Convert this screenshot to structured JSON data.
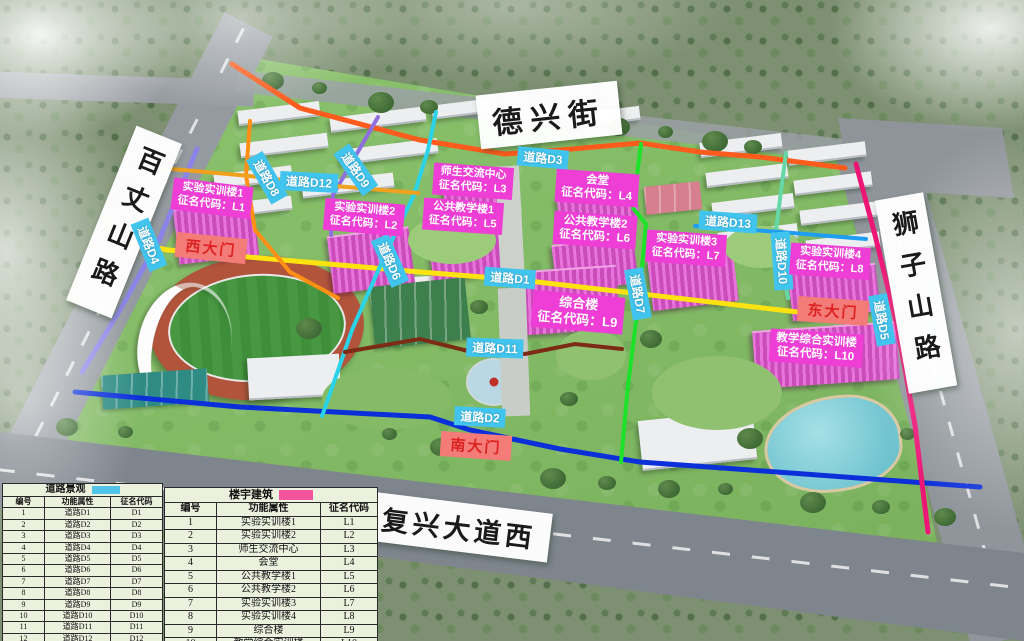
{
  "streets": {
    "top": "德兴街",
    "left": "百丈山路",
    "right": "狮子山路",
    "bottom": "复兴大道西"
  },
  "gates": [
    {
      "id": "west",
      "label": "西大门"
    },
    {
      "id": "east",
      "label": "东大门"
    },
    {
      "id": "south",
      "label": "南大门"
    }
  ],
  "roads": [
    {
      "id": "D1",
      "label": "道路D1",
      "line_color": "#ffe311"
    },
    {
      "id": "D2",
      "label": "道路D2",
      "line_color": "#0b2fd9"
    },
    {
      "id": "D3",
      "label": "道路D3",
      "line_color": "#fe5b1c"
    },
    {
      "id": "D4",
      "label": "道路D4",
      "line_color": "#8a84e8"
    },
    {
      "id": "D5",
      "label": "道路D5",
      "line_color": "#ed1677"
    },
    {
      "id": "D6",
      "label": "道路D6",
      "line_color": "#2bd3e9"
    },
    {
      "id": "D7",
      "label": "道路D7",
      "line_color": "#1ce32a"
    },
    {
      "id": "D8",
      "label": "道路D8",
      "line_color": "#ff9015"
    },
    {
      "id": "D9",
      "label": "道路D9",
      "line_color": "#8f6fdd"
    },
    {
      "id": "D10",
      "label": "道路D10",
      "line_color": "#66d8a8"
    },
    {
      "id": "D11",
      "label": "道路D11",
      "line_color": "#7c2b15"
    },
    {
      "id": "D12",
      "label": "道路D12",
      "line_color": "#f0a11e"
    },
    {
      "id": "D13",
      "label": "道路D13",
      "line_color": "#1e9df2"
    }
  ],
  "buildings": [
    {
      "id": "L1",
      "name": "实验实训楼1",
      "code": "征名代码：L1"
    },
    {
      "id": "L2",
      "name": "实验实训楼2",
      "code": "征名代码：L2"
    },
    {
      "id": "L3",
      "name": "师生交流中心",
      "code": "征名代码：L3"
    },
    {
      "id": "L4",
      "name": "会堂",
      "code": "征名代码：L4"
    },
    {
      "id": "L5",
      "name": "公共教学楼1",
      "code": "征名代码：L5"
    },
    {
      "id": "L6",
      "name": "公共教学楼2",
      "code": "征名代码：L6"
    },
    {
      "id": "L7",
      "name": "实验实训楼3",
      "code": "征名代码：L7"
    },
    {
      "id": "L8",
      "name": "实验实训楼4",
      "code": "征名代码：L8"
    },
    {
      "id": "L9",
      "name": "综合楼",
      "code": "征名代码：L9"
    },
    {
      "id": "L10",
      "name": "教学综合实训楼",
      "code": "征名代码：L10"
    }
  ],
  "legend": {
    "roads_table": {
      "title": "道路景观",
      "swatch_color": "#4fc3e8",
      "headers": [
        "编号",
        "功能属性",
        "征名代码"
      ],
      "rows": [
        [
          "1",
          "道路D1",
          "D1"
        ],
        [
          "2",
          "道路D2",
          "D2"
        ],
        [
          "3",
          "道路D3",
          "D3"
        ],
        [
          "4",
          "道路D4",
          "D4"
        ],
        [
          "5",
          "道路D5",
          "D5"
        ],
        [
          "6",
          "道路D6",
          "D6"
        ],
        [
          "7",
          "道路D7",
          "D7"
        ],
        [
          "8",
          "道路D8",
          "D8"
        ],
        [
          "9",
          "道路D9",
          "D9"
        ],
        [
          "10",
          "道路D10",
          "D10"
        ],
        [
          "11",
          "道路D11",
          "D11"
        ],
        [
          "12",
          "道路D12",
          "D12"
        ],
        [
          "13",
          "道路D13",
          "D13"
        ]
      ]
    },
    "buildings_table": {
      "title": "楼宇建筑",
      "swatch_color": "#f2549e",
      "headers": [
        "编号",
        "功能属性",
        "征名代码"
      ],
      "rows": [
        [
          "1",
          "实验实训楼1",
          "L1"
        ],
        [
          "2",
          "实验实训楼2",
          "L2"
        ],
        [
          "3",
          "师生交流中心",
          "L3"
        ],
        [
          "4",
          "会堂",
          "L4"
        ],
        [
          "5",
          "公共教学楼1",
          "L5"
        ],
        [
          "6",
          "公共教学楼2",
          "L6"
        ],
        [
          "7",
          "实验实训楼3",
          "L7"
        ],
        [
          "8",
          "实验实训楼4",
          "L8"
        ],
        [
          "9",
          "综合楼",
          "L9"
        ],
        [
          "10",
          "教学综合实训楼",
          "L10"
        ]
      ]
    }
  },
  "colors": {
    "road_chip_bg": "#41c4ee",
    "building_chip_bg": "#ee3ed6",
    "gate_bg": "#f47c78",
    "gate_text": "#dd2222"
  }
}
